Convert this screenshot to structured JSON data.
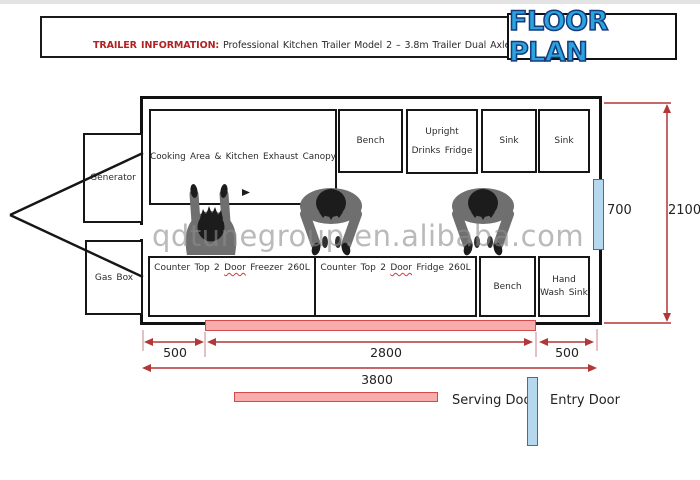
{
  "header": {
    "label": "TRAILER INFORMATION:",
    "description": "Professional Kitchen Trailer Model 2 – 3.8m Trailer Dual Axle",
    "title": "FLOOR PLAN"
  },
  "rooms": {
    "cooking": "Cooking Area & Kitchen Exhaust Canopy",
    "bench_top": "Bench",
    "upright_fridge": {
      "line1": "Upright",
      "line2": "Drinks Fridge"
    },
    "sink_1": "Sink",
    "sink_2": "Sink",
    "generator": "Generator",
    "gas_box": "Gas Box",
    "freezer": {
      "pre": "Counter Top 2",
      "door": "Door",
      "post": "Freezer 260L"
    },
    "fridge": {
      "pre": "Counter Top 2",
      "door": "Door",
      "post": "Fridge 260L"
    },
    "bench_bottom": "Bench",
    "hand_wash": {
      "line1": "Hand",
      "line2": "Wash Sink"
    }
  },
  "dimensions": {
    "door_opening": "700",
    "trailer_height": "2100",
    "left_section": "500",
    "middle_section": "2800",
    "right_section": "500",
    "total_length": "3800"
  },
  "legend": {
    "serving_label": "Serving Door",
    "entry_label": "Entry Door"
  },
  "watermark": "qdtunegroup.en.alibaba.com",
  "colors": {
    "accent_red": "#b22222",
    "title_blue": "#29a4dd",
    "title_outline": "#17397e",
    "dim_red": "#b23737",
    "dim_tick": "#c98f8f",
    "serving_fill": "#f8acac",
    "serving_border": "#d24a4a",
    "entry_fill": "#b5d8ee",
    "entry_border": "#2f74b5",
    "figure_gray": "#6f6f6f",
    "figure_dark": "#1c1c1c",
    "watermark_gray": "rgba(140,140,140,0.6)"
  }
}
